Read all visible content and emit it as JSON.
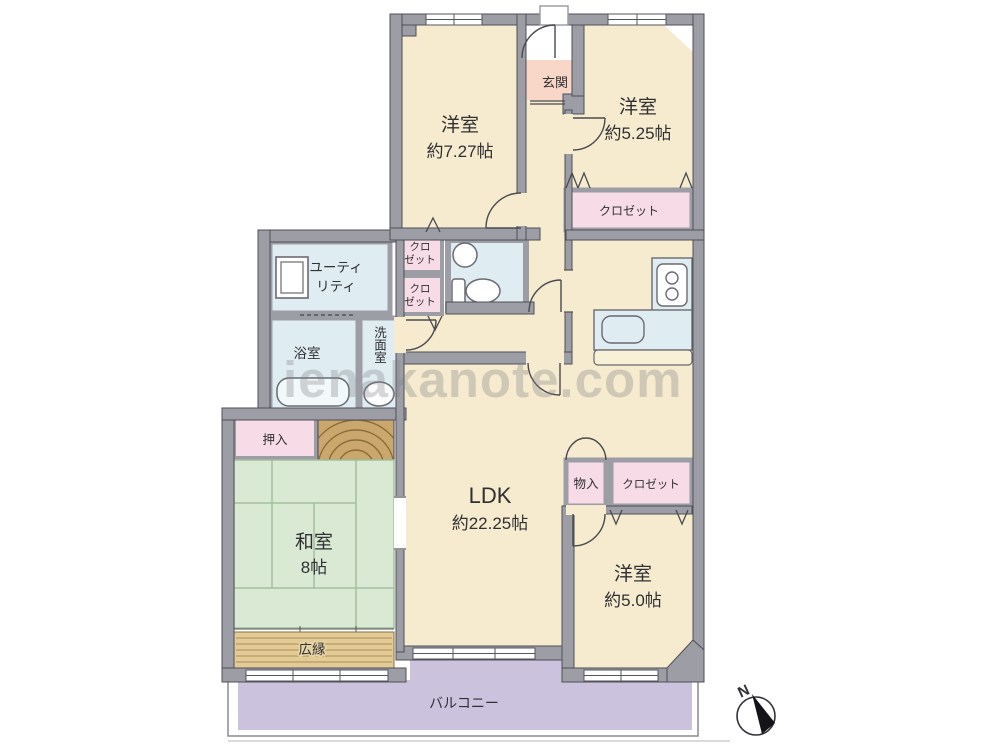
{
  "watermark": "ienakanote.com",
  "compass": {
    "label": "N"
  },
  "rooms": {
    "bedroom_top_left": {
      "name": "洋室",
      "size": "約7.27帖"
    },
    "entrance": {
      "name": "玄関"
    },
    "bedroom_top_right": {
      "name": "洋室",
      "size": "約5.25帖"
    },
    "closet_top_right": {
      "name": "クロゼット"
    },
    "closet_small_1": {
      "line1": "クロ",
      "line2": "ゼット"
    },
    "closet_small_2": {
      "line1": "クロ",
      "line2": "ゼット"
    },
    "utility": {
      "line1": "ユーティ",
      "line2": "リティ"
    },
    "bath": {
      "name": "浴室"
    },
    "washroom": {
      "name": "洗面室"
    },
    "oshiire": {
      "name": "押入"
    },
    "washitsu": {
      "name": "和室",
      "size": "8帖"
    },
    "hiroen": {
      "name": "広縁"
    },
    "ldk": {
      "name": "LDK",
      "size": "約22.25帖"
    },
    "monoire": {
      "name": "物入"
    },
    "closet_bottom_right": {
      "name": "クロゼット"
    },
    "bedroom_bottom_right": {
      "name": "洋室",
      "size": "約5.0帖"
    },
    "balcony": {
      "name": "バルコニー"
    }
  },
  "colors": {
    "room_beige": "#f6ebce",
    "entrance_pink": "#f8d7c9",
    "closet_pink": "#f7dbe7",
    "water_blue": "#dfedf2",
    "tatami_green": "#d9e9d3",
    "tatami_line": "#a3bf9f",
    "balcony_purple": "#cbc2de",
    "wood_brown": "#c9a76d",
    "hiroen_tan": "#e2cb97",
    "wall_gray": "#9d9da5",
    "outline_dark": "#4f4f57",
    "text_dark": "#303034"
  }
}
